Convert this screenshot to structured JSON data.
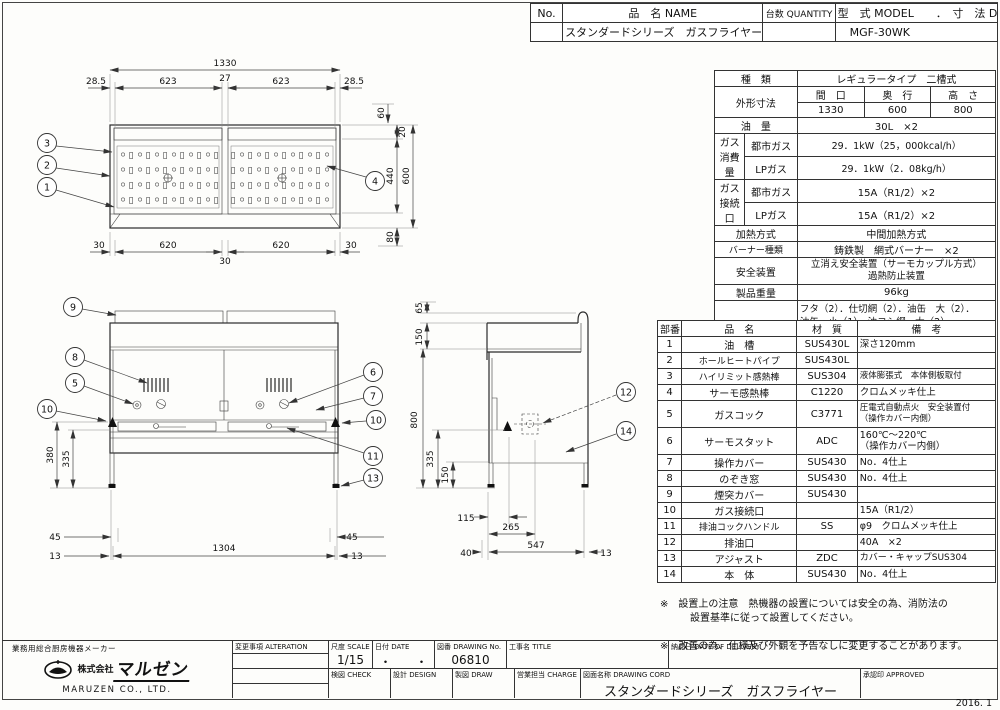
{
  "header": {
    "no_label": "No.",
    "name_label": "品　名 NAME",
    "qty_label": "台数 QUANTITY",
    "model_label": "型　式 MODEL　　．　寸　法 DIMENSION",
    "name_value": "スタンダードシリーズ　ガスフライヤー",
    "model_value": "MGF-30WK"
  },
  "spec_table": {
    "type_label": "種　類",
    "type_value": "レギュラータイプ　二槽式",
    "dims_label": "外形寸法",
    "dims_cols": [
      "間　口",
      "奥　行",
      "高　さ"
    ],
    "dims_vals": [
      "1330",
      "600",
      "800"
    ],
    "oil_label": "油　量",
    "oil_value": "30L　×2",
    "gas_consumption_label": "ガス\n消費量",
    "city_gas_label": "都市ガス",
    "city_gas_value": "29．1kW（25，000kcal/h）",
    "lp_gas_label": "LPガス",
    "lp_gas_value": "29．1kW（2．08kg/h）",
    "gas_conn_label": "ガス\n接続口",
    "conn_city_label": "都市ガス",
    "conn_city_value": "15A（R1/2）×2",
    "conn_lp_label": "LPガス",
    "conn_lp_value": "15A（R1/2）×2",
    "heating_label": "加熱方式",
    "heating_value": "中間加熱方式",
    "burner_label": "バーナー種類",
    "burner_value": "鋳鉄製　網式バーナー　×2",
    "safety_label": "安全装置",
    "safety_value": "立消え安全装置（サーモカップル方式）\n過熱防止装置",
    "weight_label": "製品重量",
    "weight_value": "96kg",
    "accessories_label": "付属品",
    "accessories_value": "フタ（2）．仕切網（2）．油缶　大（2）．\n油缶　小（1）．油コシ網　大（2）．\n油コシ網　小（1）．スクイ網（2）．\nスベリ板（2）．油切板（1）．油切網（1）"
  },
  "parts_table": {
    "headers": [
      "部番",
      "品　名",
      "材　質",
      "備　考"
    ],
    "rows": [
      {
        "no": "1",
        "name": "油　槽",
        "material": "SUS430L",
        "note": "深さ120mm"
      },
      {
        "no": "2",
        "name": "ホールヒートパイプ",
        "material": "SUS430L",
        "note": ""
      },
      {
        "no": "3",
        "name": "ハイリミット感熱棒",
        "material": "SUS304",
        "note": "液体膨張式　本体側板取付"
      },
      {
        "no": "4",
        "name": "サーモ感熱棒",
        "material": "C1220",
        "note": "クロムメッキ仕上"
      },
      {
        "no": "5",
        "name": "ガスコック",
        "material": "C3771",
        "note": "圧電式自動点火　安全装置付\n（操作カバー内側）"
      },
      {
        "no": "6",
        "name": "サーモスタット",
        "material": "ADC",
        "note": "160℃～220℃\n（操作カバー内側）"
      },
      {
        "no": "7",
        "name": "操作カバー",
        "material": "SUS430",
        "note": "No．4仕上"
      },
      {
        "no": "8",
        "name": "のぞき窓",
        "material": "SUS430",
        "note": "No．4仕上"
      },
      {
        "no": "9",
        "name": "煙突カバー",
        "material": "SUS430",
        "note": ""
      },
      {
        "no": "10",
        "name": "ガス接続口",
        "material": "",
        "note": "15A（R1/2）"
      },
      {
        "no": "11",
        "name": "排油コックハンドル",
        "material": "SS",
        "note": "φ9　クロムメッキ仕上"
      },
      {
        "no": "12",
        "name": "排油口",
        "material": "",
        "note": "40A　×2"
      },
      {
        "no": "13",
        "name": "アジャスト",
        "material": "ZDC",
        "note": "カバー・キャップSUS304"
      },
      {
        "no": "14",
        "name": "本　体",
        "material": "SUS430",
        "note": "No．4仕上"
      }
    ]
  },
  "notes": {
    "note1": "※　設置上の注意　熱機器の設置については安全の為、消防法の\n　　　設置基準に従って設置してください。",
    "note2": "※　改善の為、仕様及び外観を予告なしに変更することがあります。"
  },
  "title_block": {
    "alteration_label": "変更事項 ALTERATION",
    "scale_label": "尺度 SCALE",
    "scale_value": "1/15",
    "date_label": "日付 DATE",
    "date_value": "・　　・",
    "drawing_no_label": "図番 DRAWING No.",
    "drawing_no_value": "06810",
    "title_label": "工事名 TITLE",
    "delivery_label": "納品日 DATE OF DELIVERY",
    "check_label": "検図 CHECK",
    "design_label": "設計 DESIGN",
    "draw_label": "製図 DRAW",
    "charge_label": "営業担当 CHARGE",
    "drawing_name_label": "図面名称 DRAWING CORD",
    "drawing_name_value": "スタンダードシリーズ　ガスフライヤー",
    "approved_label": "承認印 APPROVED",
    "date_code": "2016. 1"
  },
  "company": {
    "tagline": "業務用総合厨房機器メーカー",
    "kk": "株式会社",
    "logo_text": "マルゼン",
    "name_en": "MARUZEN  CO., LTD."
  },
  "dimensions": {
    "plan": {
      "overall": "1330",
      "top": [
        "28.5",
        "623",
        "27",
        "623",
        "28.5"
      ],
      "right": [
        "60",
        "20",
        "440",
        "600",
        "80"
      ],
      "bottom": [
        "30",
        "620",
        "30",
        "620",
        "30"
      ]
    },
    "front": {
      "left": [
        "380",
        "335"
      ],
      "bottom": [
        "45",
        "13",
        "1304",
        "13",
        "45"
      ]
    },
    "side": {
      "top": [
        "65",
        "150"
      ],
      "left": [
        "800",
        "335",
        "150"
      ],
      "bottom": [
        "115",
        "265",
        "40",
        "547",
        "13"
      ]
    }
  },
  "balloons": [
    "1",
    "2",
    "3",
    "4",
    "5",
    "6",
    "7",
    "8",
    "9",
    "10",
    "11",
    "12",
    "13",
    "14"
  ],
  "colors": {
    "line": "#2b2b2b",
    "paper": "#fdfdfb"
  }
}
